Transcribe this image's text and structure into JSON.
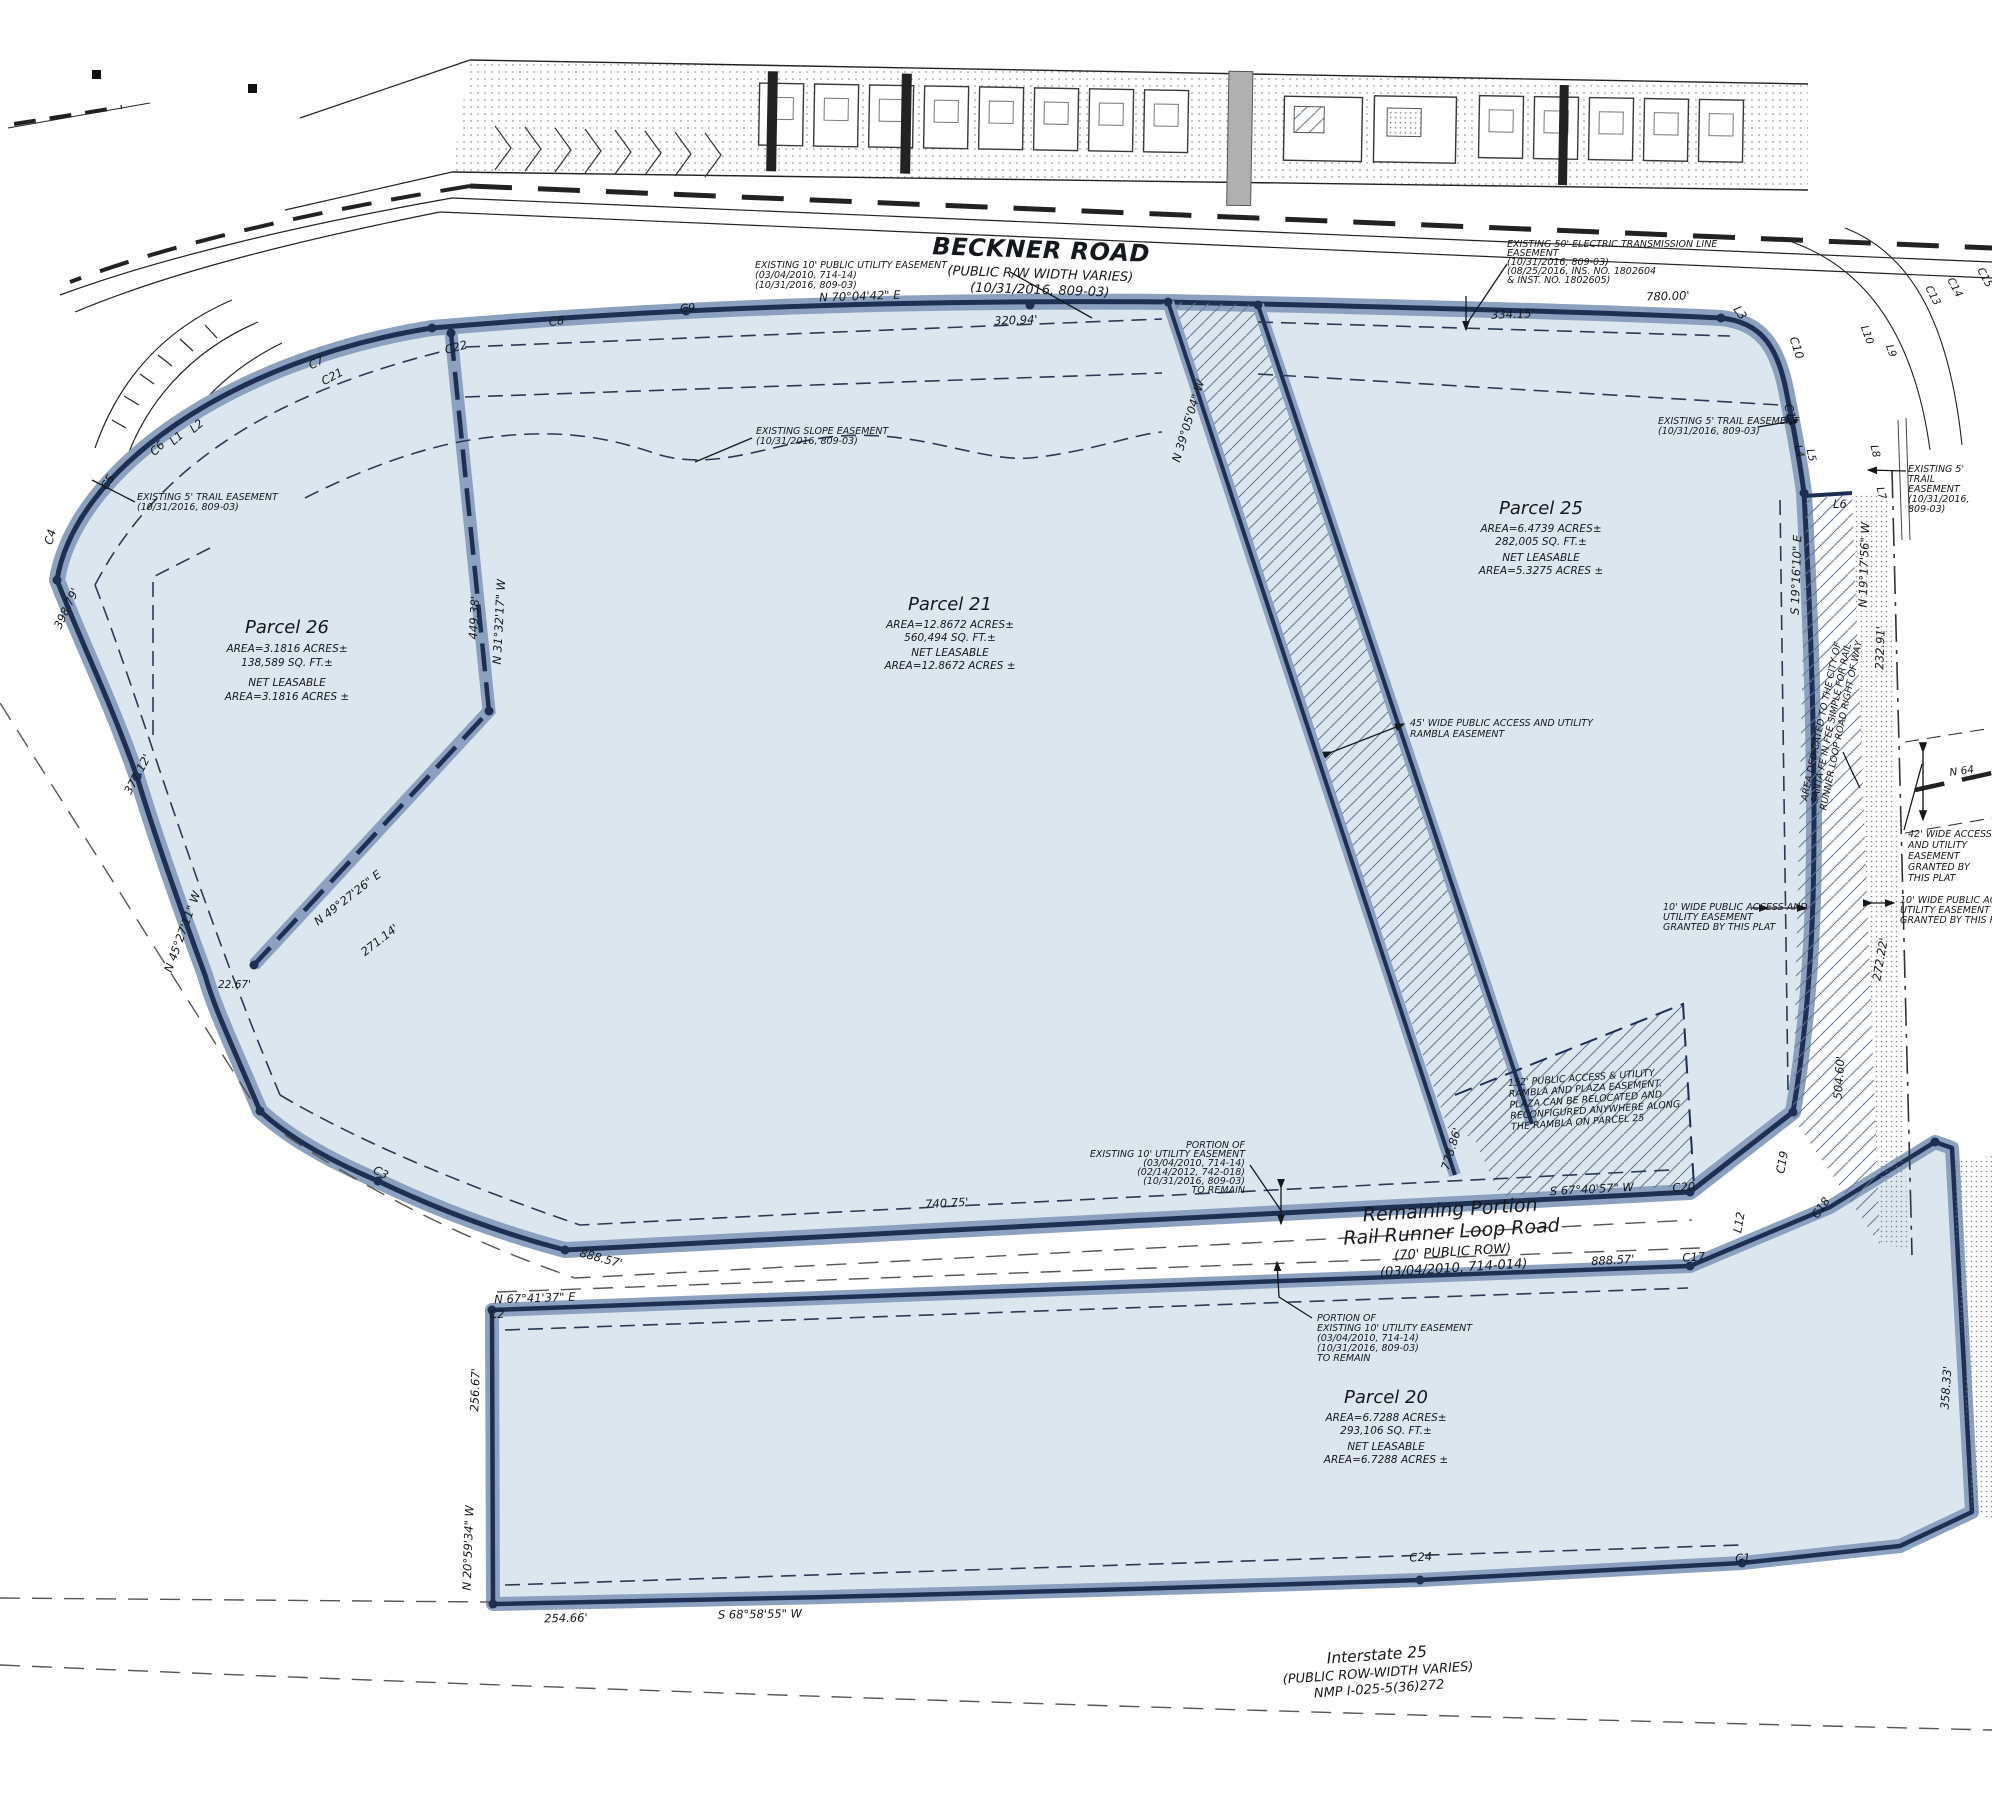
{
  "colors": {
    "parcel_fill": "#dce6ef",
    "boundary_band": "#8ba1bf",
    "boundary_line": "#1d3054",
    "hatch_line": "#64748c",
    "text": "#15181c"
  },
  "roads": {
    "beckner": [
      "BECKNER ROAD",
      "(PUBLIC R/W WIDTH VARIES)",
      "(10/31/2016, 809-03)"
    ],
    "rail_runner": [
      "Remaining Portion",
      "Rail Runner Loop Road",
      "(70' PUBLIC ROW)",
      "(03/04/2010, 714-014)"
    ],
    "interstate": [
      "Interstate 25",
      "(PUBLIC ROW-WIDTH VARIES)",
      "NMP I-025-5(36)272"
    ],
    "n64": "N 64"
  },
  "parcels": {
    "p26": [
      "Parcel 26",
      "AREA=3.1816 ACRES±",
      "138,589 SQ. FT.±",
      "NET LEASABLE",
      "AREA=3.1816 ACRES ±"
    ],
    "p21": [
      "Parcel 21",
      "AREA=12.8672 ACRES±",
      "560,494 SQ. FT.±",
      "NET LEASABLE",
      "AREA=12.8672 ACRES ±"
    ],
    "p25": [
      "Parcel 25",
      "AREA=6.4739 ACRES±",
      "282,005 SQ. FT.±",
      "NET LEASABLE",
      "AREA=5.3275 ACRES ±"
    ],
    "p20": [
      "Parcel 20",
      "AREA=6.7288 ACRES±",
      "293,106 SQ. FT.±",
      "NET LEASABLE",
      "AREA=6.7288 ACRES ±"
    ]
  },
  "notes": {
    "util_top": [
      "EXISTING 10' PUBLIC UTILITY EASEMENT",
      "(03/04/2010, 714-14)",
      "(10/31/2016, 809-03)"
    ],
    "electric": [
      "EXISTING 50' ELECTRIC TRANSMISSION LINE",
      "EASEMENT",
      "(10/31/2016, 809-03)",
      "(08/25/2016, INS. NO. 1802604",
      "& INST. NO. 1802605)"
    ],
    "slope": [
      "EXISTING SLOPE EASEMENT",
      "(10/31/2016, 809-03)"
    ],
    "trail_left": [
      "EXISTING 5' TRAIL EASEMENT",
      "(10/31/2016, 809-03)"
    ],
    "trail_right": [
      "EXISTING 5' TRAIL EASEMENT",
      "(10/31/2016, 809-03)"
    ],
    "trail_farright": [
      "EXISTING 5'",
      "TRAIL",
      "EASEMENT",
      "(10/31/2016,",
      "809-03)"
    ],
    "rambla45": [
      "45' WIDE PUBLIC ACCESS AND UTILITY",
      "RAMBLA EASEMENT"
    ],
    "plaza152": [
      "152' PUBLIC ACCESS & UTILITY",
      "RAMBLA AND PLAZA EASEMENT.",
      "PLAZA CAN BE RELOCATED AND",
      "RECONFIGURED ANYWHERE ALONG",
      "THE RAMBLA ON PARCEL 25"
    ],
    "access10_left": [
      "10' WIDE PUBLIC ACCESS AND",
      "UTILITY EASEMENT",
      "GRANTED BY THIS PLAT"
    ],
    "access10_right": [
      "10' WIDE PUBLIC ACCESS",
      "UTILITY EASEMENT",
      "GRANTED BY THIS PLAT"
    ],
    "access42": [
      "42' WIDE ACCESS",
      "AND UTILITY",
      "EASEMENT",
      "GRANTED BY",
      "THIS PLAT"
    ],
    "portion_top": [
      "PORTION OF",
      "EXISTING 10' UTILITY EASEMENT",
      "(03/04/2010, 714-14)",
      "(02/14/2012, 742-018)",
      "(10/31/2016, 809-03)",
      "TO REMAIN"
    ],
    "portion_bottom": [
      "PORTION OF",
      "EXISTING 10' UTILITY EASEMENT",
      "(03/04/2010, 714-14)",
      "(10/31/2016, 809-03)",
      "TO REMAIN"
    ],
    "dedication": [
      "AREA DEDICATED TO THE CITY OF",
      "SANTA FE IN FEE SIMPLE FOR RAIL",
      "RUNNER LOOP ROAD RIGHT OF WAY"
    ]
  },
  "bearings": {
    "n70": "N 70°04'42\" E",
    "d320": "320.94'",
    "d334": "334.15'",
    "d780": "780.00'",
    "n3905": "N 39°05'04\" W",
    "d77886": "778.86'",
    "s1916": "S 19°16'10\" E",
    "n1917": "N 19°17'56\" W",
    "d23291": "232.91'",
    "d50460": "504.60'",
    "d27222": "272.22'",
    "d35833": "358.33'",
    "n3132": "N 31°32'17\" W",
    "d44938": "449.38'",
    "n4927": "N 49°27'26\" E",
    "d27114": "271.14'",
    "d2267": "22.67'",
    "n4527": "N 45°27'11\" W",
    "d37712": "377.12'",
    "d39879": "398.79'",
    "s6740": "S 67°40'57\" W",
    "d74075": "740.75'",
    "d888a": "888.57'",
    "d888b": "888.57'",
    "n6741": "N 67°41'37\" E",
    "d25667": "256.67'",
    "n2059": "N 20°59'34\" W",
    "d25466": "254.66'",
    "s6858": "S 68°58'55\" W"
  },
  "labels": {
    "c1": "C1",
    "c2": "C2",
    "c3": "C3",
    "c4": "C4",
    "c5": "C5",
    "c6": "C6",
    "c7": "C7",
    "c8": "C8",
    "c9": "C9",
    "c10": "C10",
    "c11": "C11",
    "c13": "C13",
    "c14": "C14",
    "c15": "C15",
    "c17": "C17",
    "c18": "C18",
    "c19": "C19",
    "c20": "C20",
    "c21": "C21",
    "c22": "C22",
    "c24": "C24",
    "l1": "L1",
    "l2": "L2",
    "l3": "L3",
    "l4": "L4",
    "l5": "L5",
    "l6": "L6",
    "l7": "L7",
    "l8": "L8",
    "l9": "L9",
    "l10": "L10",
    "l12": "L12"
  }
}
